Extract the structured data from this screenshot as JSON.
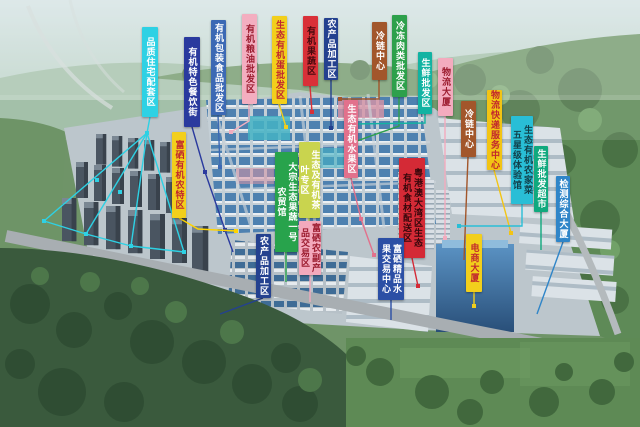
{
  "image": {
    "width": 640,
    "height": 427,
    "description": "Aerial bird's-eye rendering of an eco agricultural trade town surrounded by forested hills, with vertical colored zone labels pointing to building clusters"
  },
  "palette": {
    "haze_sky": "#cfdfe0",
    "hill_green": "#5e8a57",
    "forest_dark": "#3a5a3d",
    "field_green": "#5e8a55",
    "road_grey": "#a8aeb2",
    "market_roof_blue": "#4e81b0",
    "glass_tower_blue": "#294f79",
    "building_white": "#dbe2e7"
  },
  "labels": [
    {
      "id": "pinzhi-zhuzhai",
      "text": "品质住宅配套区",
      "display": "品质住宅配套区",
      "bg": "#2ED1E4",
      "fg": "#ffffff",
      "x": 142,
      "y": 27,
      "w": 16,
      "h": 90,
      "connector": {
        "lines": [
          [
            [
              150,
              117
            ],
            [
              147,
              133
            ]
          ],
          [
            [
              147,
              133
            ],
            [
              44,
              221
            ]
          ],
          [
            [
              147,
              133
            ],
            [
              86,
              234
            ]
          ],
          [
            [
              147,
              133
            ],
            [
              131,
              246
            ]
          ],
          [
            [
              147,
              133
            ],
            [
              184,
              252
            ]
          ],
          [
            [
              44,
              221
            ],
            [
              86,
              234
            ],
            [
              131,
              246
            ],
            [
              184,
              252
            ]
          ]
        ],
        "dots": [
          [
            147,
            133
          ],
          [
            44,
            221
          ],
          [
            86,
            234
          ],
          [
            131,
            246
          ],
          [
            184,
            252
          ],
          [
            97,
            180
          ],
          [
            120,
            192
          ]
        ]
      }
    },
    {
      "id": "canyin-jie",
      "text": "有机特色餐饮街",
      "display": "有机特色餐饮街",
      "bg": "#2A3A9E",
      "fg": "#ffffff",
      "x": 184,
      "y": 37,
      "w": 16,
      "h": 90,
      "connector": {
        "lines": [
          [
            [
              192,
              127
            ],
            [
              205,
              172
            ],
            [
              225,
              230
            ],
            [
              233,
              252
            ]
          ]
        ],
        "dots": [
          [
            205,
            172
          ],
          [
            225,
            230
          ]
        ]
      }
    },
    {
      "id": "baozhuang-shipin",
      "text": "有机包装食品批发区",
      "display": "有机包装食品批发区",
      "bg": "#3C69B4",
      "fg": "#ffffff",
      "x": 211,
      "y": 20,
      "w": 15,
      "h": 95,
      "connector": {
        "lines": [
          [
            [
              218,
              115
            ],
            [
              220,
              167
            ]
          ]
        ],
        "dots": [
          [
            220,
            167
          ]
        ]
      }
    },
    {
      "id": "liangyou-pifa",
      "text": "有机粮油批发区",
      "display": "有机粮油批发区",
      "bg": "#F3AEC0",
      "fg": "#9B1B2E",
      "x": 242,
      "y": 14,
      "w": 15,
      "h": 90,
      "connector": {
        "lines": [
          [
            [
              249,
              104
            ],
            [
              249,
              121
            ],
            [
              231,
              132
            ]
          ]
        ],
        "dots": [
          [
            231,
            132
          ]
        ]
      }
    },
    {
      "id": "dan-pifa",
      "text": "生态有机蛋批发区",
      "display": "生态有机蛋批发区",
      "bg": "#F2CF1C",
      "fg": "#C1272D",
      "x": 272,
      "y": 16,
      "w": 15,
      "h": 88,
      "connector": {
        "lines": [
          [
            [
              279,
              104
            ],
            [
              286,
              127
            ]
          ]
        ],
        "dots": [
          [
            286,
            127
          ]
        ]
      }
    },
    {
      "id": "guoshu-qu",
      "text": "有机果蔬区",
      "display": "有机果蔬区",
      "bg": "#D93038",
      "fg": "#47090D",
      "x": 303,
      "y": 16,
      "w": 15,
      "h": 70,
      "connector": {
        "lines": [
          [
            [
              310,
              86
            ],
            [
              312,
              112
            ]
          ]
        ],
        "dots": [
          [
            312,
            112
          ]
        ]
      }
    },
    {
      "id": "nongchanpin-jiagong-bei",
      "text": "农产品加工区",
      "display": "农产品加工区",
      "bg": "#24418F",
      "fg": "#ffffff",
      "x": 324,
      "y": 18,
      "w": 14,
      "h": 62,
      "connector": {
        "lines": [
          [
            [
              331,
              80
            ],
            [
              331,
              128
            ]
          ]
        ],
        "dots": [
          [
            331,
            128
          ]
        ]
      }
    },
    {
      "id": "lenglian-zhongxin-1",
      "text": "冷链中心",
      "display": "冷链中心",
      "bg": "#A2562B",
      "fg": "#ffffff",
      "x": 372,
      "y": 22,
      "w": 15,
      "h": 58,
      "connector": {
        "lines": [
          [
            [
              379,
              80
            ],
            [
              379,
              99
            ],
            [
              340,
              99
            ]
          ]
        ],
        "dots": [
          [
            340,
            99
          ]
        ]
      }
    },
    {
      "id": "lengdong-roulei",
      "text": "冷冻肉类批发区",
      "display": "冷冻肉类批发区",
      "bg": "#2DA04B",
      "fg": "#ffffff",
      "x": 392,
      "y": 15,
      "w": 15,
      "h": 82,
      "connector": {
        "lines": [
          [
            [
              399,
              97
            ],
            [
              399,
              126
            ],
            [
              354,
              142
            ]
          ]
        ],
        "dots": [
          [
            354,
            142
          ]
        ]
      }
    },
    {
      "id": "shengxian-pifa-qu",
      "text": "生鲜批发区",
      "display": "生鲜批发区",
      "bg": "#12B3A2",
      "fg": "#ffffff",
      "x": 418,
      "y": 52,
      "w": 14,
      "h": 62,
      "connector": {
        "lines": [
          [
            [
              425,
              114
            ],
            [
              425,
              123
            ],
            [
              352,
              124
            ]
          ]
        ],
        "dots": [
          [
            352,
            124
          ]
        ]
      }
    },
    {
      "id": "wuliu-dasha",
      "text": "物流大厦",
      "display": "物流大厦",
      "bg": "#F3ABBE",
      "fg": "#9B1B2E",
      "x": 438,
      "y": 58,
      "w": 15,
      "h": 58,
      "connector": {
        "lines": [
          [
            [
              445,
              116
            ],
            [
              445,
              238
            ]
          ]
        ],
        "dots": [
          [
            445,
            238
          ]
        ]
      }
    },
    {
      "id": "lenglian-zhongxin-2",
      "text": "冷链中心",
      "display": "冷链中心",
      "bg": "#A2562B",
      "fg": "#ffffff",
      "x": 461,
      "y": 101,
      "w": 15,
      "h": 56,
      "connector": {
        "lines": [
          [
            [
              468,
              157
            ],
            [
              464,
              260
            ]
          ]
        ],
        "dots": []
      }
    },
    {
      "id": "wuliu-kuaidi-fuwu",
      "text": "物流快递服务中心",
      "display": "物流快递服务中心",
      "bg": "#F2C414",
      "fg": "#C1272D",
      "x": 487,
      "y": 90,
      "w": 15,
      "h": 80,
      "connector": {
        "lines": [
          [
            [
              494,
              170
            ],
            [
              511,
              233
            ]
          ]
        ],
        "dots": [
          [
            511,
            233
          ]
        ]
      }
    },
    {
      "id": "nongjiacai-tiyanguan",
      "text": "生态有机农家菜五星级体验馆",
      "display": "生态有机农家菜\n五星级体验馆",
      "bg": "#29BED6",
      "fg": "#113F4A",
      "x": 511,
      "y": 116,
      "w": 22,
      "h": 88,
      "connector": {
        "lines": [
          [
            [
              522,
              204
            ],
            [
              522,
              226
            ],
            [
              459,
              226
            ]
          ]
        ],
        "dots": [
          [
            459,
            226
          ]
        ]
      }
    },
    {
      "id": "shengxian-chaoshi",
      "text": "生鲜批发超市",
      "display": "生鲜批发超市",
      "bg": "#10A97E",
      "fg": "#ffffff",
      "x": 534,
      "y": 146,
      "w": 14,
      "h": 66,
      "connector": {
        "lines": [
          [
            [
              541,
              212
            ],
            [
              541,
              250
            ]
          ]
        ],
        "dots": []
      }
    },
    {
      "id": "jiance-dasha",
      "text": "检测综合大厦",
      "display": "检测综合大厦",
      "bg": "#2F85C8",
      "fg": "#ffffff",
      "x": 556,
      "y": 176,
      "w": 14,
      "h": 66,
      "connector": {
        "lines": [
          [
            [
              563,
              242
            ],
            [
              537,
              314
            ]
          ]
        ],
        "dots": []
      }
    },
    {
      "id": "fuxi-nongte-qu",
      "text": "富硒有机农特区",
      "display": "富硒有机农特区",
      "bg": "#F2CF1C",
      "fg": "#C1272D",
      "x": 172,
      "y": 132,
      "w": 14,
      "h": 86,
      "connector": {
        "color": "#FFD400",
        "lines": [
          [
            [
              179,
              218
            ],
            [
              198,
              229
            ],
            [
              236,
              231
            ]
          ]
        ],
        "dots": [
          [
            236,
            231
          ]
        ]
      }
    },
    {
      "id": "youji-shuiguo-qu",
      "text": "生态有机水果区",
      "display": "生态有机水果区",
      "bg": "#E2718C",
      "fg": "#ffffff",
      "x": 344,
      "y": 100,
      "w": 14,
      "h": 78,
      "connector": {
        "lines": [
          [
            [
              351,
              178
            ],
            [
              361,
              219
            ],
            [
              374,
              255
            ]
          ]
        ],
        "dots": [
          [
            361,
            219
          ],
          [
            374,
            255
          ]
        ]
      }
    },
    {
      "id": "dawanqu-peisong-qu",
      "text": "粤港澳大湾区生态有机食材配送区",
      "display": "粤港澳大湾区生态\n有机食材配送区",
      "bg": "#D42A36",
      "fg": "#35070B",
      "x": 399,
      "y": 158,
      "w": 26,
      "h": 100,
      "connector": {
        "lines": [
          [
            [
              412,
              258
            ],
            [
              418,
              286
            ]
          ]
        ],
        "dots": [
          [
            418,
            286
          ]
        ]
      }
    },
    {
      "id": "dazong-nongmaoguan",
      "text": "大宗生态果蔬一号农贸馆",
      "display": "大宗生态果蔬一号\n农贸馆",
      "bg": "#28A34C",
      "fg": "#ffffff",
      "x": 275,
      "y": 152,
      "w": 23,
      "h": 100,
      "connector": {
        "lines": [
          [
            [
              286,
              252
            ],
            [
              286,
              282
            ]
          ]
        ],
        "dots": []
      }
    },
    {
      "id": "chaye-zhuanqu",
      "text": "生态及有机茶叶专区",
      "display": "生态及有机茶\n叶专区",
      "bg": "#C9D44E",
      "fg": "#ffffff",
      "x": 299,
      "y": 142,
      "w": 21,
      "h": 76,
      "connector": {
        "lines": [
          [
            [
              309,
              218
            ],
            [
              309,
              238
            ]
          ]
        ],
        "dots": []
      }
    },
    {
      "id": "fuxi-jiaoyi-qu",
      "text": "富硒农副产品交易区",
      "display": "富硒农副产\n品交易区",
      "bg": "#F3A9BC",
      "fg": "#9B1B2E",
      "x": 299,
      "y": 221,
      "w": 22,
      "h": 54,
      "connector": {
        "lines": [
          [
            [
              310,
              275
            ],
            [
              310,
              302
            ]
          ]
        ],
        "dots": []
      }
    },
    {
      "id": "nongchanpin-jiagong-nan",
      "text": "农产品加工区",
      "display": "农产品加工区",
      "bg": "#24418F",
      "fg": "#ffffff",
      "x": 256,
      "y": 234,
      "w": 15,
      "h": 64,
      "connector": {
        "lines": [
          [
            [
              263,
              298
            ],
            [
              220,
              314
            ]
          ]
        ],
        "dots": []
      }
    },
    {
      "id": "jingpin-shuiguo-jiaoyi",
      "text": "富硒精品水果交易中心",
      "display": "富硒精品水\n果交易中心",
      "bg": "#2B4FA5",
      "fg": "#ffffff",
      "x": 378,
      "y": 238,
      "w": 26,
      "h": 62,
      "connector": {
        "lines": [
          [
            [
              391,
              300
            ],
            [
              391,
              320
            ]
          ]
        ],
        "dots": []
      }
    },
    {
      "id": "dianshang-dasha",
      "text": "电商大厦",
      "display": "电商大厦",
      "bg": "#F2CF1C",
      "fg": "#C1272D",
      "x": 466,
      "y": 234,
      "w": 16,
      "h": 58,
      "connector": {
        "lines": [
          [
            [
              474,
              292
            ],
            [
              474,
              306
            ]
          ]
        ],
        "dots": [
          [
            474,
            306
          ]
        ]
      }
    }
  ]
}
